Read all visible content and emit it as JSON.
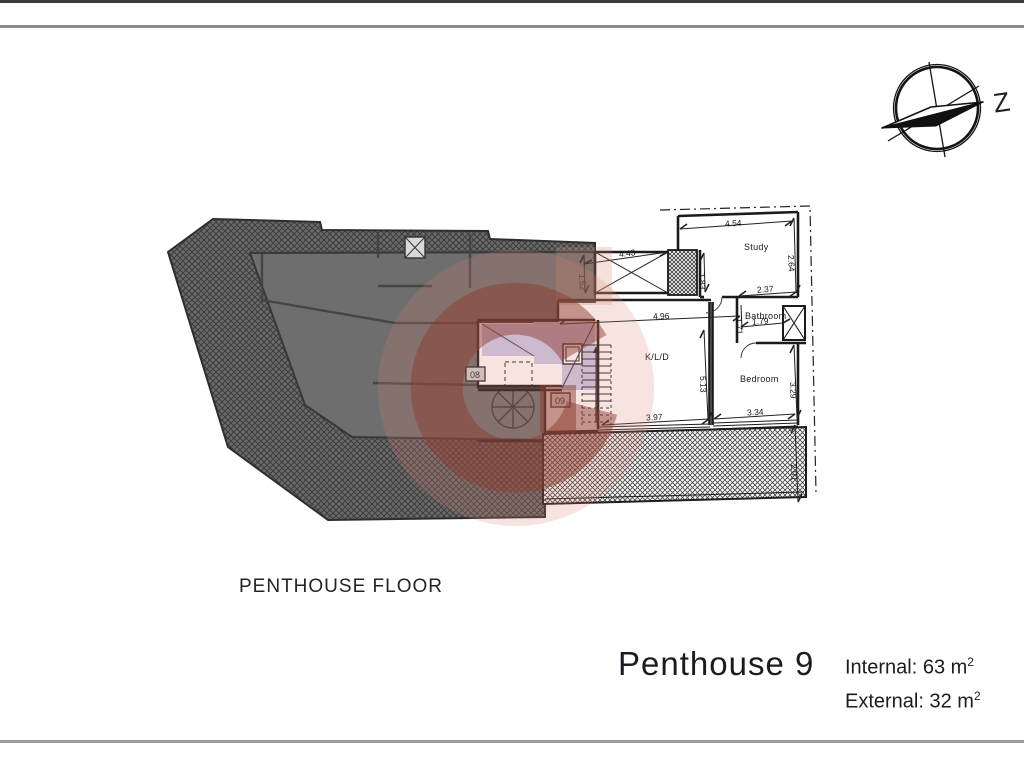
{
  "frame": {
    "compass_letter": "Z"
  },
  "titles": {
    "floor_label": "PENTHOUSE FLOOR",
    "unit_name": "Penthouse 9"
  },
  "areas": {
    "internal": {
      "text": "Internal: 63 m",
      "sup": "2"
    },
    "external": {
      "text": "External: 32 m",
      "sup": "2"
    }
  },
  "plan": {
    "rooms": {
      "study": "Study",
      "bathroom": "Bathroom",
      "bedroom": "Bedroom",
      "kld": "K/L/D"
    },
    "units": {
      "u08": "08",
      "u09": "09"
    },
    "dims": {
      "study_w": "4.54",
      "study_h": "2.64",
      "void_w": "4.43",
      "void_h": "1.52",
      "shaft_h": "1.83",
      "bath_top_w": "2.37",
      "bath_w": "1.79",
      "bath_h": "1.71",
      "kld_w": "4.96",
      "kld_h": "5.13",
      "bedroom_h": "3.29",
      "kld_bottom_w": "3.97",
      "bedroom_w": "3.34",
      "terrace_d": "2.01"
    },
    "colors": {
      "watermark": "#8b3a2e",
      "stair_highlight": "#c9c9ea",
      "adjacent_unit_gray": "#6e6e6e"
    }
  }
}
